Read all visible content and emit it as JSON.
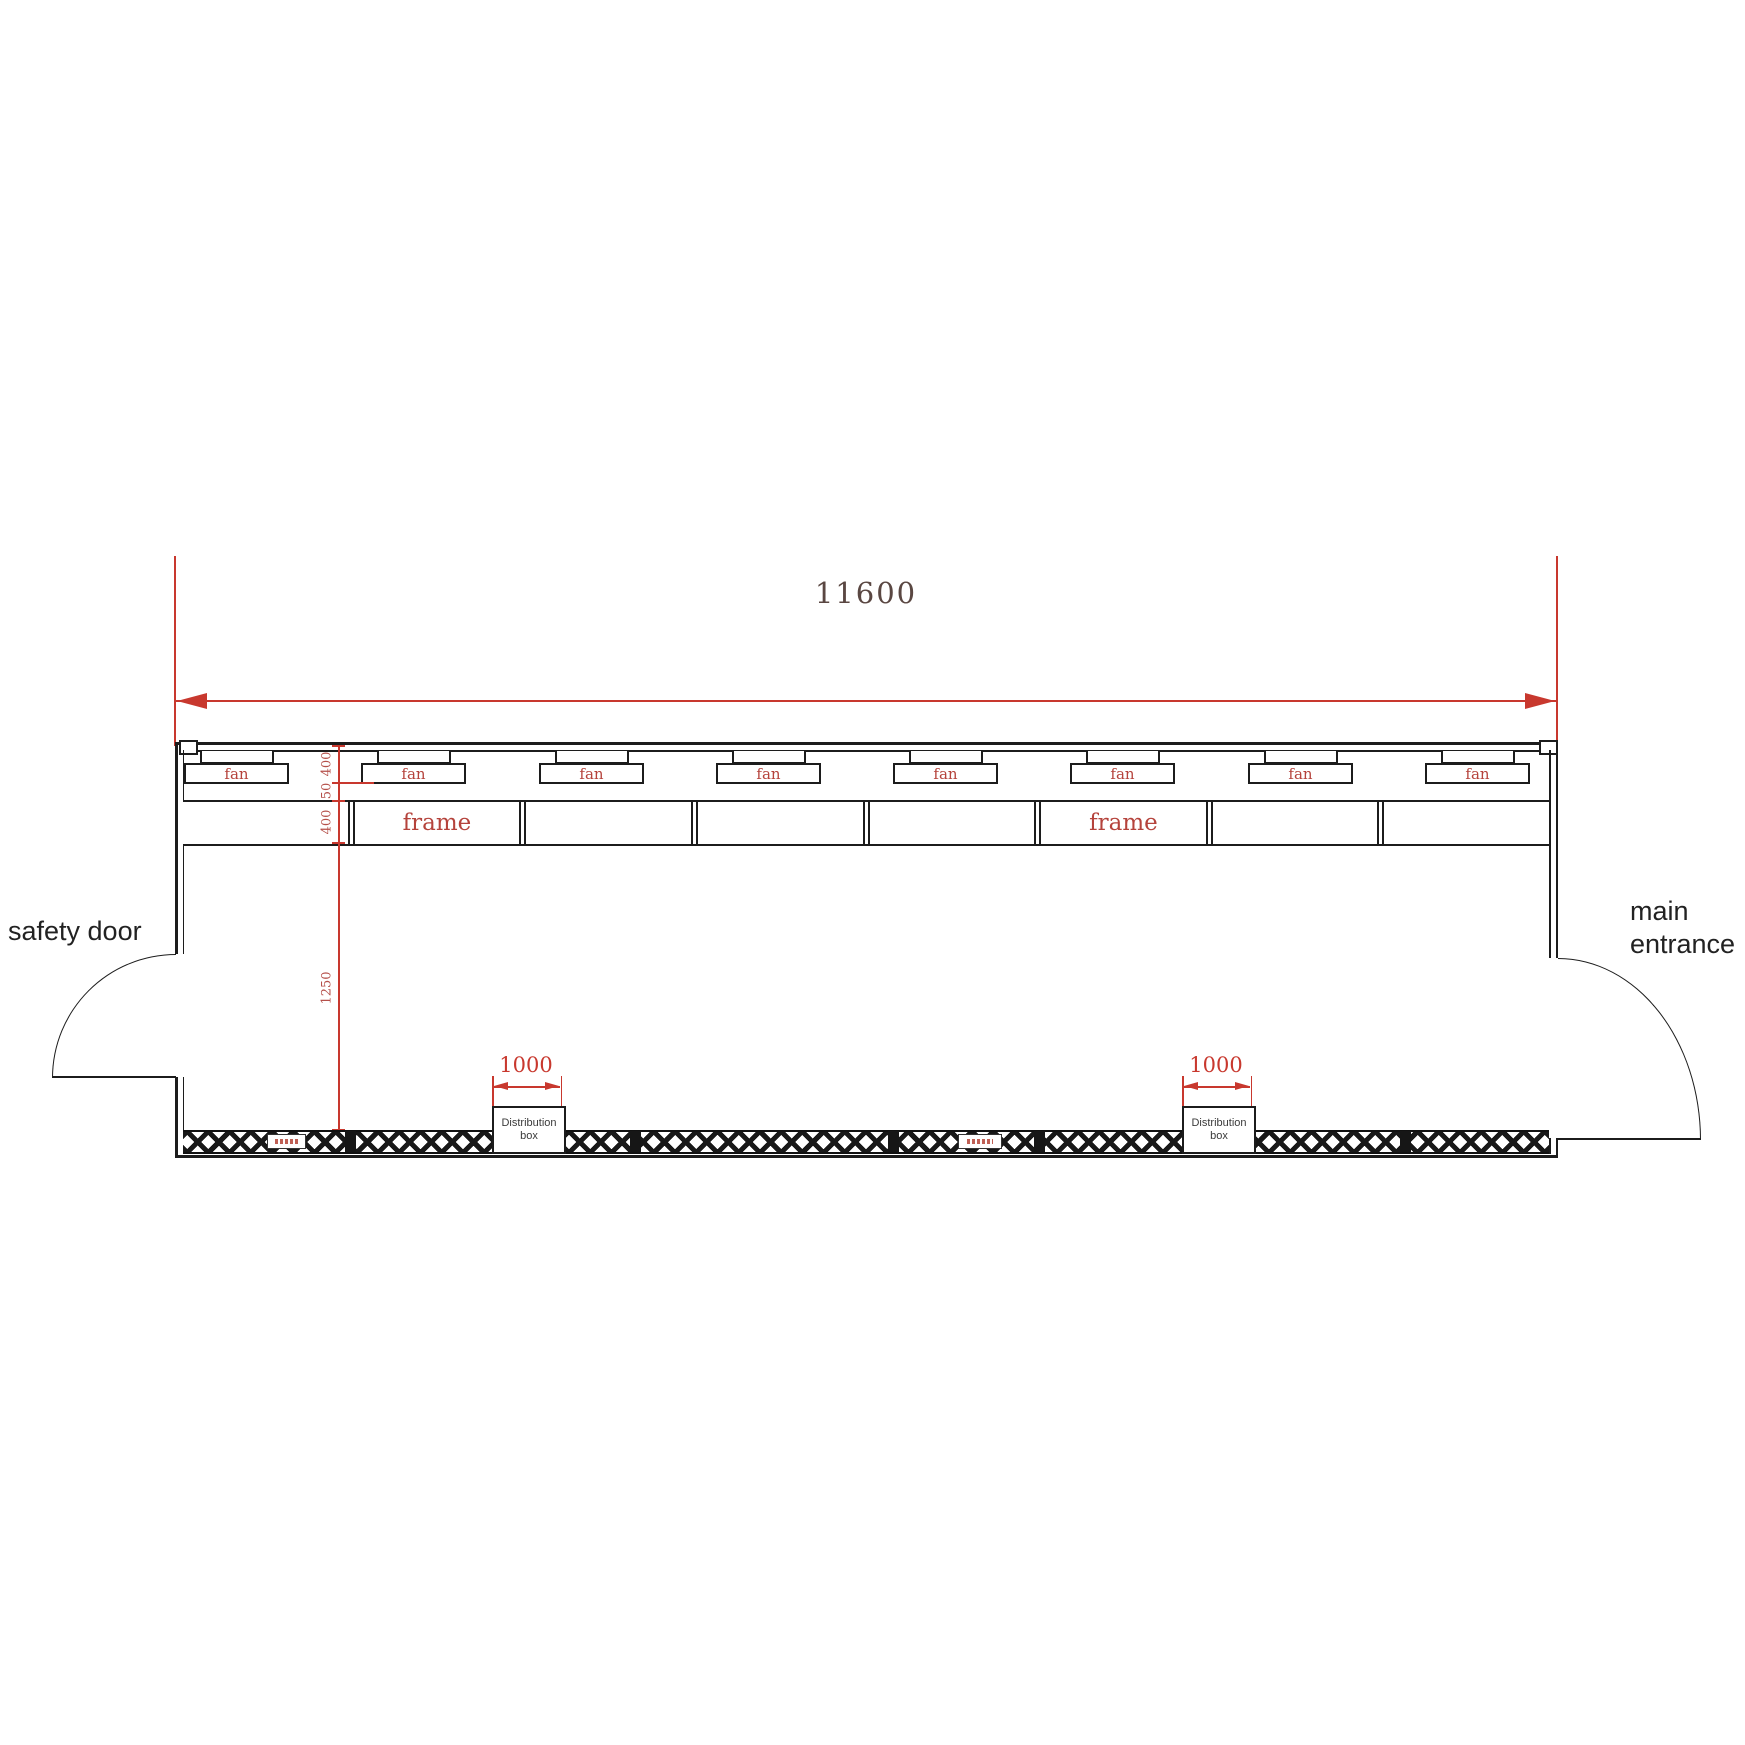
{
  "dimensions": {
    "overall_width": "11600",
    "fan_depth": "400",
    "fan_gap": "50",
    "frame_depth": "400",
    "interior_depth": "1250"
  },
  "fans": [
    "fan",
    "fan",
    "fan",
    "fan",
    "fan",
    "fan",
    "fan",
    "fan"
  ],
  "frame_panels": [
    "",
    "frame",
    "",
    "",
    "",
    "frame",
    "",
    ""
  ],
  "doors": {
    "safety_door": "safety door",
    "main_entrance_line1": "main",
    "main_entrance_line2": "entrance"
  },
  "distribution_boxes": [
    {
      "width_dim": "1000",
      "line1": "Distribution",
      "line2": "box"
    },
    {
      "width_dim": "1000",
      "line1": "Distribution",
      "line2": "box"
    }
  ],
  "colors": {
    "dimension_red": "#c8382e",
    "label_red": "#b5433c",
    "dim_text_dark": "#5a4742",
    "line_black": "#1c1c1c"
  }
}
